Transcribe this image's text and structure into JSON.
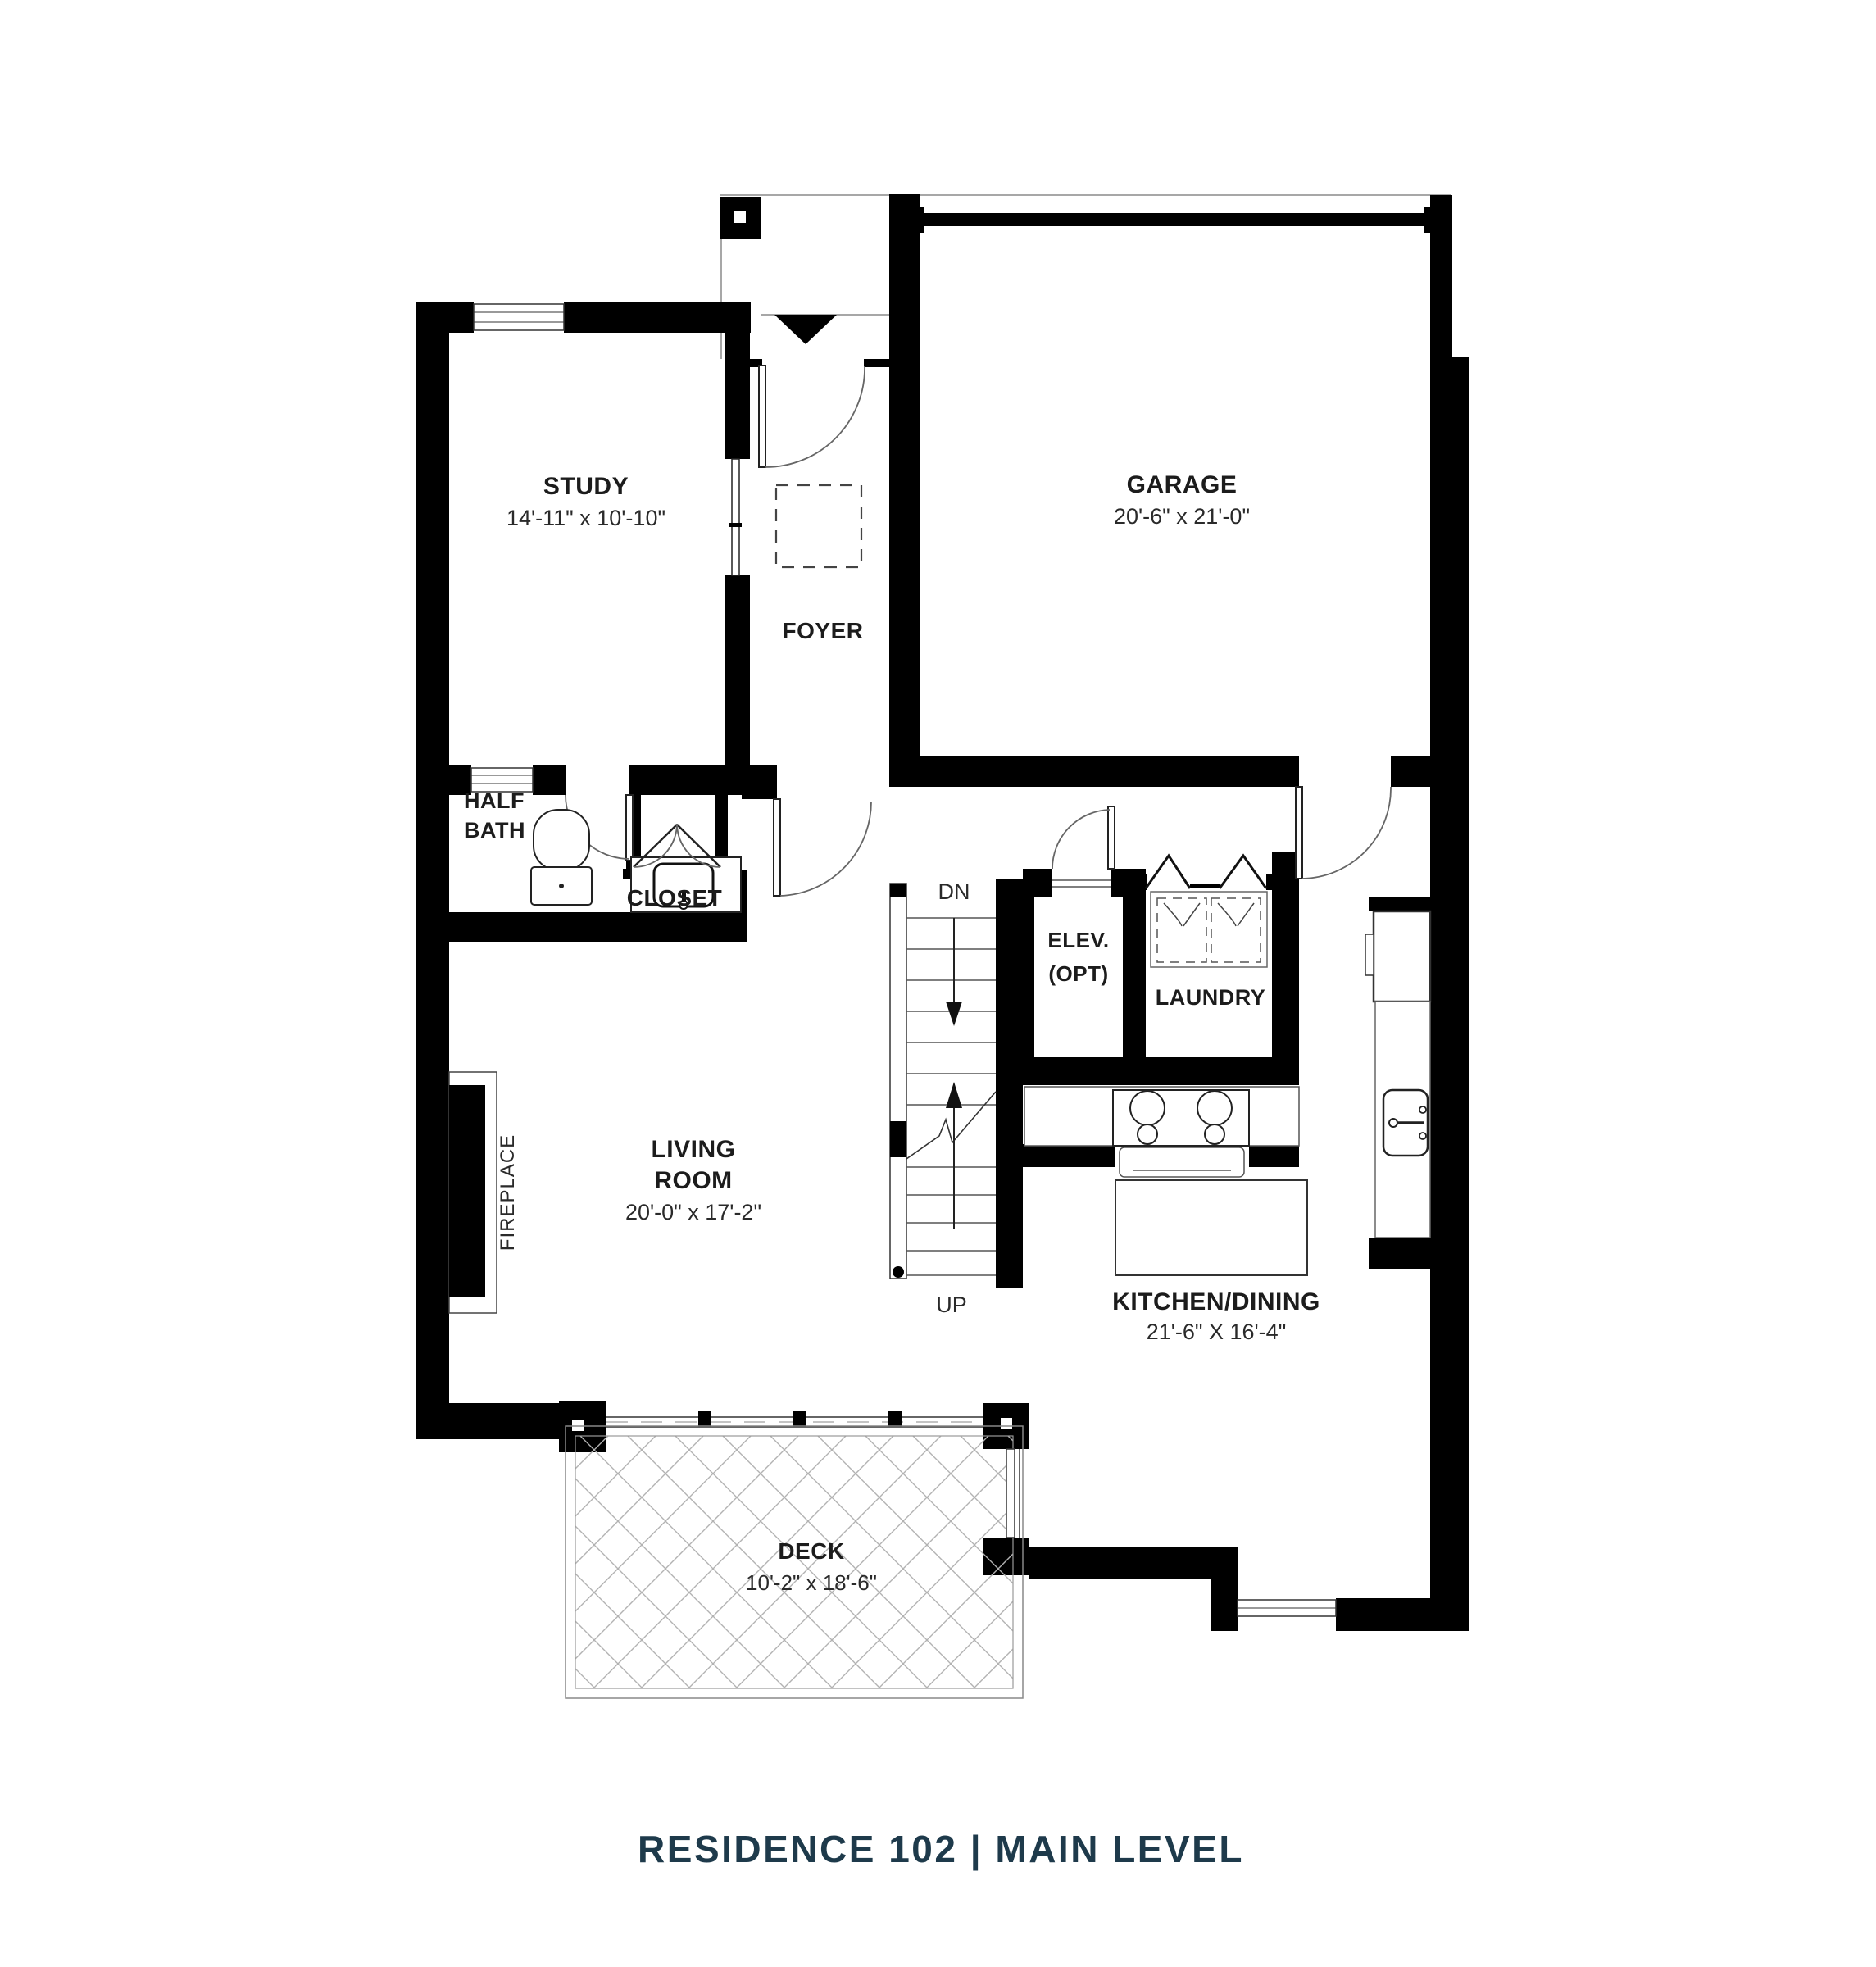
{
  "title": {
    "text": "RESIDENCE 102   |   MAIN LEVEL",
    "color": "#1e3a4b"
  },
  "rooms": {
    "study": {
      "name": "STUDY",
      "dims": "14'-11\" x 10'-10\""
    },
    "garage": {
      "name": "GARAGE",
      "dims": "20'-6\" x 21'-0\""
    },
    "foyer": {
      "name": "FOYER"
    },
    "half_bath": {
      "line1": "HALF",
      "line2": "BATH"
    },
    "closet": {
      "name": "CLOSET"
    },
    "elevator": {
      "line1": "ELEV.",
      "line2": "(OPT)"
    },
    "laundry": {
      "name": "LAUNDRY"
    },
    "living_room": {
      "line1": "LIVING",
      "line2": "ROOM",
      "dims": "20'-0\" x 17'-2\""
    },
    "kitchen_dining": {
      "name": "KITCHEN/DINING",
      "dims": "21'-6\" X 16'-4\""
    },
    "deck": {
      "name": "DECK",
      "dims": "10'-2\" x 18'-6\""
    },
    "fireplace": {
      "name": "FIREPLACE"
    }
  },
  "stairs": {
    "down_label": "DN",
    "up_label": "UP"
  }
}
